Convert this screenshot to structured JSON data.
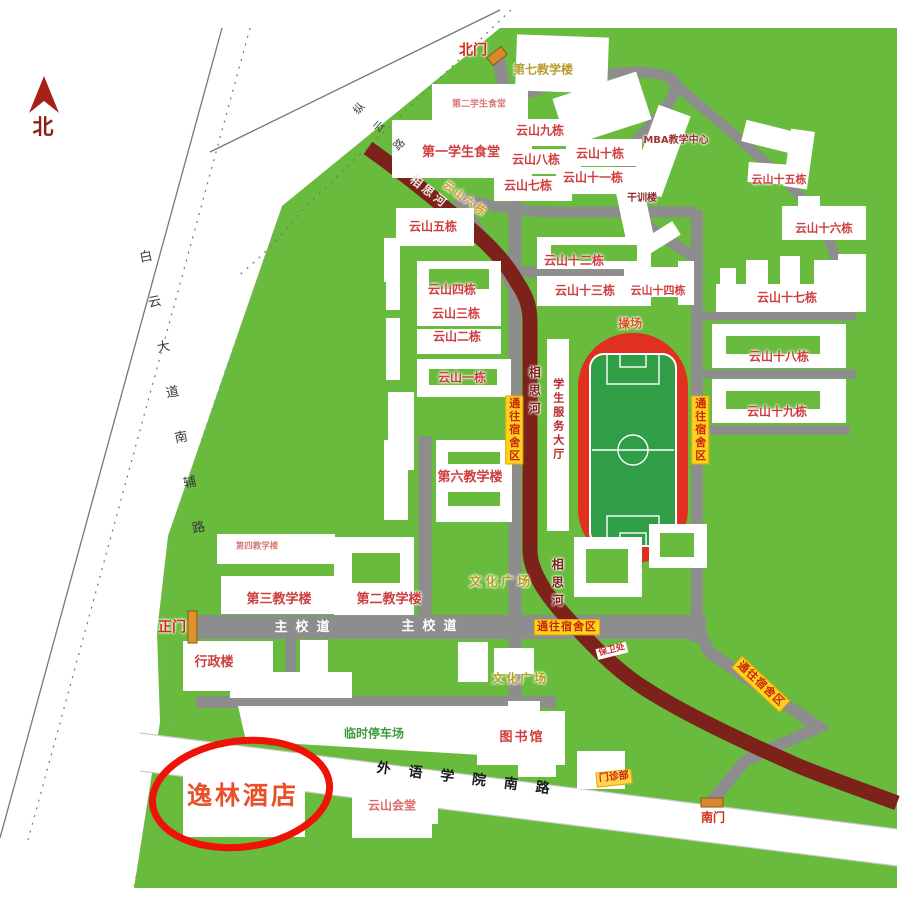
{
  "compass": {
    "label": "北"
  },
  "gates": {
    "north": "北门",
    "main": "正门",
    "south": "南门"
  },
  "roads": {
    "baiyun": "白云大道南辅路",
    "zongyun": "纵云路",
    "south": "外语学院南路",
    "main_road": "主校道",
    "to_dorm": "通往宿舍区"
  },
  "river": {
    "name": "相思河"
  },
  "areas": {
    "playground": "操场",
    "culture_plaza_1": "文化广场",
    "culture_plaza_2": "文化广场",
    "parking": "临时停车场"
  },
  "buildings": {
    "teach7": "第七教学楼",
    "canteen2": "第二学生食堂",
    "canteen1": "第一学生食堂",
    "mba": "MBA教学中心",
    "ganxun": "干训楼",
    "yunshan1": "云山一栋",
    "yunshan2": "云山二栋",
    "yunshan3": "云山三栋",
    "yunshan4": "云山四栋",
    "yunshan5": "云山五栋",
    "yunshan6": "云山六栋",
    "yunshan7": "云山七栋",
    "yunshan8": "云山八栋",
    "yunshan9": "云山九栋",
    "yunshan10": "云山十栋",
    "yunshan11": "云山十一栋",
    "yunshan12": "云山十二栋",
    "yunshan13": "云山十三栋",
    "yunshan14": "云山十四栋",
    "yunshan15": "云山十五栋",
    "yunshan16": "云山十六栋",
    "yunshan17": "云山十七栋",
    "yunshan18": "云山十八栋",
    "yunshan19": "云山十九栋",
    "student_hall": "学生服务大厅",
    "teach6": "第六教学楼",
    "teach4": "第四教学楼",
    "teach3": "第三教学楼",
    "teach2": "第二教学楼",
    "admin": "行政楼",
    "security": "保卫处",
    "library": "图书馆",
    "clinic": "门诊部",
    "hall": "云山会堂",
    "hotel": "逸林酒店"
  },
  "colors": {
    "campus_green": "#68bb3c",
    "road_gray": "#8d8d8d",
    "river_maroon": "#7d211b",
    "track_red": "#e03020",
    "pitch_green": "#2f9e47",
    "sign_yellow": "#ffd21c",
    "sign_text_red": "#c8240e",
    "gate_orange": "#d9882b",
    "highlight_circle_red": "#ee1208",
    "hotel_text_orange": "#ea4f28",
    "label_red": "#cf3e3e",
    "plaza_text_olive": "#b3a11a",
    "parking_text_green": "#3d9b3d"
  }
}
